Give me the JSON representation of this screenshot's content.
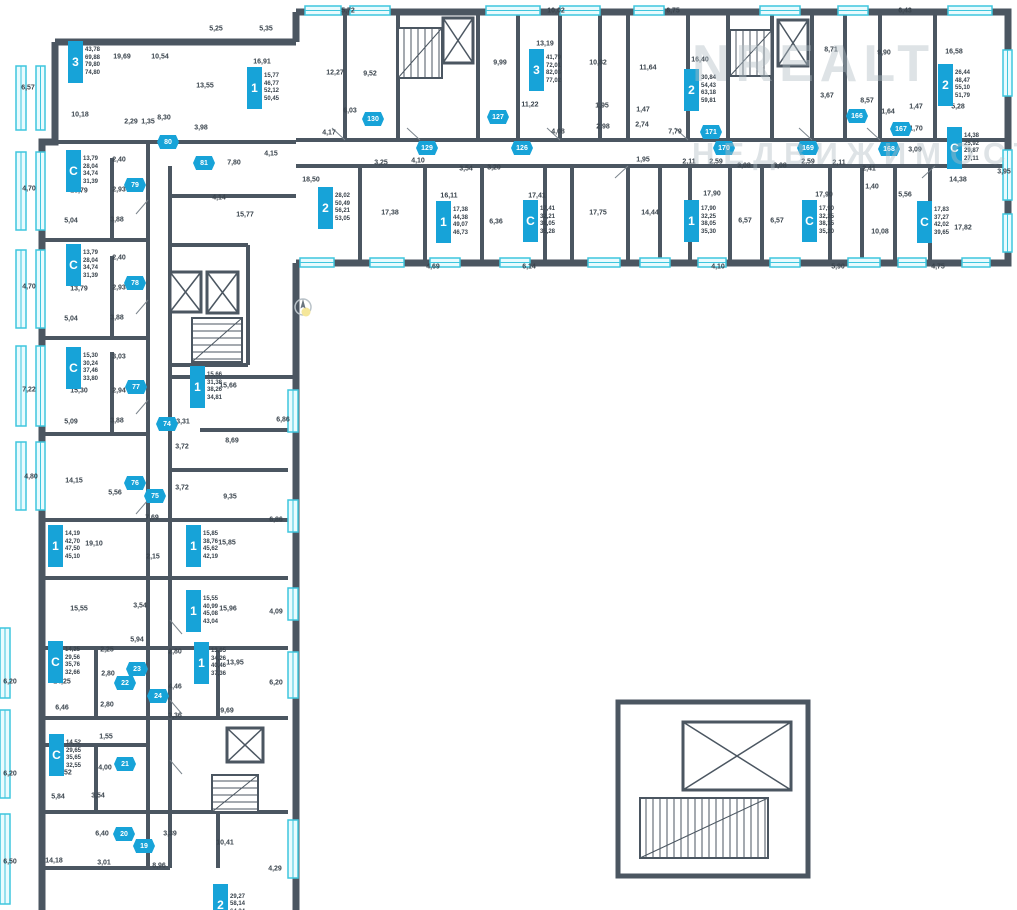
{
  "watermark": {
    "line1": "NREALT",
    "line2": "НЕДВИЖИМОСТЬ"
  },
  "colors": {
    "wall": "#4b5661",
    "accent": "#17a3d8",
    "window": "#3fc6de",
    "label": "#39434c"
  },
  "units": [
    {
      "type": "3",
      "x": 68,
      "y": 41,
      "areas": [
        "43,78",
        "69,88",
        "79,80",
        "74,80"
      ]
    },
    {
      "type": "1",
      "x": 247,
      "y": 67,
      "areas": [
        "15,77",
        "46,77",
        "52,12",
        "50,45"
      ]
    },
    {
      "type": "2",
      "x": 318,
      "y": 187,
      "areas": [
        "28,02",
        "50,49",
        "56,21",
        "53,05"
      ]
    },
    {
      "type": "1",
      "x": 436,
      "y": 201,
      "areas": [
        "17,38",
        "44,38",
        "49,07",
        "46,73"
      ]
    },
    {
      "type": "C",
      "x": 523,
      "y": 200,
      "areas": [
        "17,41",
        "32,21",
        "38,05",
        "35,28"
      ]
    },
    {
      "type": "3",
      "x": 529,
      "y": 49,
      "areas": [
        "41,79",
        "72,01",
        "82,03",
        "77,02"
      ]
    },
    {
      "type": "2",
      "x": 684,
      "y": 69,
      "areas": [
        "30,84",
        "54,43",
        "63,18",
        "59,81"
      ]
    },
    {
      "type": "1",
      "x": 684,
      "y": 200,
      "areas": [
        "17,90",
        "32,25",
        "38,05",
        "35,30"
      ]
    },
    {
      "type": "C",
      "x": 802,
      "y": 200,
      "areas": [
        "17,90",
        "32,25",
        "38,15",
        "35,20"
      ]
    },
    {
      "type": "2",
      "x": 938,
      "y": 64,
      "areas": [
        "26,44",
        "48,47",
        "55,10",
        "51,79"
      ]
    },
    {
      "type": "C",
      "x": 947,
      "y": 127,
      "areas": [
        "14,38",
        "25,92",
        "29,87",
        "27,11"
      ]
    },
    {
      "type": "C",
      "x": 917,
      "y": 201,
      "areas": [
        "17,83",
        "37,27",
        "42,02",
        "39,65"
      ]
    },
    {
      "type": "C",
      "x": 66,
      "y": 150,
      "areas": [
        "13,79",
        "28,04",
        "34,74",
        "31,39"
      ]
    },
    {
      "type": "C",
      "x": 66,
      "y": 244,
      "areas": [
        "13,79",
        "28,04",
        "34,74",
        "31,39"
      ]
    },
    {
      "type": "C",
      "x": 66,
      "y": 347,
      "areas": [
        "15,30",
        "30,24",
        "37,46",
        "33,80"
      ]
    },
    {
      "type": "1",
      "x": 190,
      "y": 366,
      "areas": [
        "15,66",
        "31,38",
        "38,26",
        "34,81"
      ]
    },
    {
      "type": "1",
      "x": 48,
      "y": 525,
      "areas": [
        "14,19",
        "42,70",
        "47,50",
        "45,10"
      ]
    },
    {
      "type": "1",
      "x": 186,
      "y": 525,
      "areas": [
        "15,85",
        "38,76",
        "45,62",
        "42,19"
      ]
    },
    {
      "type": "1",
      "x": 186,
      "y": 590,
      "areas": [
        "15,55",
        "40,99",
        "45,08",
        "43,04"
      ]
    },
    {
      "type": "C",
      "x": 48,
      "y": 641,
      "areas": [
        "14,25",
        "29,56",
        "35,76",
        "32,66"
      ]
    },
    {
      "type": "1",
      "x": 194,
      "y": 642,
      "areas": [
        "13,95",
        "34,26",
        "40,46",
        "37,36"
      ]
    },
    {
      "type": "C",
      "x": 49,
      "y": 734,
      "areas": [
        "14,52",
        "29,65",
        "35,65",
        "32,55"
      ]
    },
    {
      "type": "2",
      "x": 213,
      "y": 884,
      "areas": [
        "29,27",
        "58,14",
        "64,34"
      ]
    }
  ],
  "hex_badges": [
    {
      "x": 168,
      "y": 142,
      "label": "80"
    },
    {
      "x": 204,
      "y": 163,
      "label": "81"
    },
    {
      "x": 135,
      "y": 185,
      "label": "79"
    },
    {
      "x": 135,
      "y": 283,
      "label": "78"
    },
    {
      "x": 136,
      "y": 387,
      "label": "77"
    },
    {
      "x": 167,
      "y": 424,
      "label": "74"
    },
    {
      "x": 135,
      "y": 483,
      "label": "76"
    },
    {
      "x": 155,
      "y": 496,
      "label": "75"
    },
    {
      "x": 373,
      "y": 119,
      "label": "130"
    },
    {
      "x": 427,
      "y": 148,
      "label": "129"
    },
    {
      "x": 498,
      "y": 117,
      "label": "127"
    },
    {
      "x": 522,
      "y": 148,
      "label": "126"
    },
    {
      "x": 711,
      "y": 132,
      "label": "171"
    },
    {
      "x": 724,
      "y": 148,
      "label": "170"
    },
    {
      "x": 808,
      "y": 148,
      "label": "169"
    },
    {
      "x": 857,
      "y": 116,
      "label": "166"
    },
    {
      "x": 901,
      "y": 129,
      "label": "167"
    },
    {
      "x": 889,
      "y": 149,
      "label": "168"
    },
    {
      "x": 137,
      "y": 669,
      "label": "23"
    },
    {
      "x": 125,
      "y": 683,
      "label": "22"
    },
    {
      "x": 158,
      "y": 696,
      "label": "24"
    },
    {
      "x": 125,
      "y": 764,
      "label": "21"
    },
    {
      "x": 124,
      "y": 834,
      "label": "20"
    },
    {
      "x": 144,
      "y": 846,
      "label": "19"
    }
  ],
  "room_labels": [
    {
      "x": 122,
      "y": 57,
      "t": "19,69"
    },
    {
      "x": 160,
      "y": 57,
      "t": "10,54"
    },
    {
      "x": 205,
      "y": 86,
      "t": "13,55"
    },
    {
      "x": 80,
      "y": 115,
      "t": "10,18"
    },
    {
      "x": 131,
      "y": 122,
      "t": "2,29"
    },
    {
      "x": 148,
      "y": 122,
      "t": "1,35"
    },
    {
      "x": 164,
      "y": 118,
      "t": "8,30"
    },
    {
      "x": 201,
      "y": 128,
      "t": "3,98"
    },
    {
      "x": 28,
      "y": 88,
      "t": "6,57"
    },
    {
      "x": 216,
      "y": 29,
      "t": "5,25"
    },
    {
      "x": 266,
      "y": 29,
      "t": "5,35"
    },
    {
      "x": 262,
      "y": 62,
      "t": "16,91"
    },
    {
      "x": 271,
      "y": 154,
      "t": "4,15"
    },
    {
      "x": 234,
      "y": 163,
      "t": "7,80"
    },
    {
      "x": 219,
      "y": 198,
      "t": "4,14"
    },
    {
      "x": 245,
      "y": 215,
      "t": "15,77"
    },
    {
      "x": 335,
      "y": 73,
      "t": "12,27"
    },
    {
      "x": 370,
      "y": 74,
      "t": "9,52"
    },
    {
      "x": 350,
      "y": 111,
      "t": "6,03"
    },
    {
      "x": 329,
      "y": 133,
      "t": "4,17"
    },
    {
      "x": 311,
      "y": 180,
      "t": "18,50"
    },
    {
      "x": 381,
      "y": 163,
      "t": "3,25"
    },
    {
      "x": 418,
      "y": 161,
      "t": "4,10"
    },
    {
      "x": 390,
      "y": 213,
      "t": "17,38"
    },
    {
      "x": 449,
      "y": 196,
      "t": "16,11"
    },
    {
      "x": 466,
      "y": 169,
      "t": "3,54"
    },
    {
      "x": 494,
      "y": 168,
      "t": "3,20"
    },
    {
      "x": 537,
      "y": 196,
      "t": "17,41"
    },
    {
      "x": 496,
      "y": 222,
      "t": "6,36"
    },
    {
      "x": 500,
      "y": 63,
      "t": "9,99"
    },
    {
      "x": 545,
      "y": 44,
      "t": "13,19"
    },
    {
      "x": 598,
      "y": 63,
      "t": "10,82"
    },
    {
      "x": 648,
      "y": 68,
      "t": "11,64"
    },
    {
      "x": 530,
      "y": 105,
      "t": "11,22"
    },
    {
      "x": 602,
      "y": 106,
      "t": "1,95"
    },
    {
      "x": 643,
      "y": 110,
      "t": "1,47"
    },
    {
      "x": 558,
      "y": 132,
      "t": "4,08"
    },
    {
      "x": 603,
      "y": 127,
      "t": "2,98"
    },
    {
      "x": 642,
      "y": 125,
      "t": "2,74"
    },
    {
      "x": 643,
      "y": 160,
      "t": "1,95"
    },
    {
      "x": 598,
      "y": 213,
      "t": "17,75"
    },
    {
      "x": 650,
      "y": 213,
      "t": "14,44"
    },
    {
      "x": 700,
      "y": 60,
      "t": "16,40"
    },
    {
      "x": 675,
      "y": 132,
      "t": "7,79"
    },
    {
      "x": 831,
      "y": 50,
      "t": "8,71"
    },
    {
      "x": 884,
      "y": 53,
      "t": "9,90"
    },
    {
      "x": 954,
      "y": 52,
      "t": "16,58"
    },
    {
      "x": 827,
      "y": 96,
      "t": "3,67"
    },
    {
      "x": 867,
      "y": 101,
      "t": "8,57"
    },
    {
      "x": 888,
      "y": 112,
      "t": "1,64"
    },
    {
      "x": 916,
      "y": 107,
      "t": "1,47"
    },
    {
      "x": 958,
      "y": 107,
      "t": "5,28"
    },
    {
      "x": 916,
      "y": 129,
      "t": "1,70"
    },
    {
      "x": 915,
      "y": 150,
      "t": "3,09"
    },
    {
      "x": 869,
      "y": 169,
      "t": "2,41"
    },
    {
      "x": 872,
      "y": 187,
      "t": "1,40"
    },
    {
      "x": 905,
      "y": 195,
      "t": "5,56"
    },
    {
      "x": 958,
      "y": 180,
      "t": "14,38"
    },
    {
      "x": 1004,
      "y": 172,
      "t": "3,95"
    },
    {
      "x": 880,
      "y": 232,
      "t": "10,08"
    },
    {
      "x": 963,
      "y": 228,
      "t": "17,82"
    },
    {
      "x": 689,
      "y": 162,
      "t": "2,11"
    },
    {
      "x": 716,
      "y": 162,
      "t": "2,59"
    },
    {
      "x": 744,
      "y": 166,
      "t": "3,08"
    },
    {
      "x": 780,
      "y": 166,
      "t": "3,08"
    },
    {
      "x": 808,
      "y": 162,
      "t": "2,59"
    },
    {
      "x": 839,
      "y": 163,
      "t": "2,11"
    },
    {
      "x": 712,
      "y": 194,
      "t": "17,90"
    },
    {
      "x": 824,
      "y": 195,
      "t": "17,90"
    },
    {
      "x": 745,
      "y": 221,
      "t": "6,57"
    },
    {
      "x": 777,
      "y": 221,
      "t": "6,57"
    },
    {
      "x": 433,
      "y": 267,
      "t": "4,69"
    },
    {
      "x": 529,
      "y": 267,
      "t": "6,14"
    },
    {
      "x": 718,
      "y": 267,
      "t": "4,10"
    },
    {
      "x": 838,
      "y": 267,
      "t": "5,90"
    },
    {
      "x": 938,
      "y": 267,
      "t": "4,75"
    },
    {
      "x": 348,
      "y": 11,
      "t": "5,72"
    },
    {
      "x": 556,
      "y": 11,
      "t": "10,02"
    },
    {
      "x": 673,
      "y": 11,
      "t": "6,75"
    },
    {
      "x": 905,
      "y": 11,
      "t": "6,43"
    },
    {
      "x": 29,
      "y": 189,
      "t": "4,70"
    },
    {
      "x": 119,
      "y": 160,
      "t": "2,40"
    },
    {
      "x": 79,
      "y": 191,
      "t": "13,79"
    },
    {
      "x": 119,
      "y": 190,
      "t": "2,93"
    },
    {
      "x": 71,
      "y": 221,
      "t": "5,04"
    },
    {
      "x": 117,
      "y": 220,
      "t": "3,88"
    },
    {
      "x": 29,
      "y": 287,
      "t": "4,70"
    },
    {
      "x": 119,
      "y": 258,
      "t": "2,40"
    },
    {
      "x": 79,
      "y": 289,
      "t": "13,79"
    },
    {
      "x": 119,
      "y": 288,
      "t": "2,93"
    },
    {
      "x": 71,
      "y": 319,
      "t": "5,04"
    },
    {
      "x": 117,
      "y": 318,
      "t": "3,88"
    },
    {
      "x": 29,
      "y": 390,
      "t": "7,22"
    },
    {
      "x": 119,
      "y": 357,
      "t": "3,03"
    },
    {
      "x": 79,
      "y": 391,
      "t": "15,30"
    },
    {
      "x": 119,
      "y": 391,
      "t": "2,94"
    },
    {
      "x": 71,
      "y": 422,
      "t": "5,09"
    },
    {
      "x": 117,
      "y": 421,
      "t": "3,88"
    },
    {
      "x": 31,
      "y": 477,
      "t": "4,80"
    },
    {
      "x": 74,
      "y": 481,
      "t": "14,15"
    },
    {
      "x": 115,
      "y": 493,
      "t": "5,56"
    },
    {
      "x": 228,
      "y": 386,
      "t": "15,66"
    },
    {
      "x": 283,
      "y": 420,
      "t": "6,86"
    },
    {
      "x": 183,
      "y": 422,
      "t": "3,31"
    },
    {
      "x": 182,
      "y": 447,
      "t": "3,72"
    },
    {
      "x": 232,
      "y": 441,
      "t": "8,69"
    },
    {
      "x": 182,
      "y": 488,
      "t": "3,72"
    },
    {
      "x": 230,
      "y": 497,
      "t": "9,35"
    },
    {
      "x": 152,
      "y": 518,
      "t": "7,69"
    },
    {
      "x": 94,
      "y": 544,
      "t": "19,10"
    },
    {
      "x": 153,
      "y": 557,
      "t": "2,15"
    },
    {
      "x": 227,
      "y": 543,
      "t": "15,85"
    },
    {
      "x": 276,
      "y": 520,
      "t": "6,86"
    },
    {
      "x": 79,
      "y": 609,
      "t": "15,55"
    },
    {
      "x": 140,
      "y": 606,
      "t": "3,54"
    },
    {
      "x": 137,
      "y": 640,
      "t": "5,94"
    },
    {
      "x": 228,
      "y": 609,
      "t": "15,96"
    },
    {
      "x": 276,
      "y": 612,
      "t": "4,09"
    },
    {
      "x": 62,
      "y": 682,
      "t": "14,25"
    },
    {
      "x": 107,
      "y": 650,
      "t": "2,25"
    },
    {
      "x": 108,
      "y": 674,
      "t": "2,80"
    },
    {
      "x": 175,
      "y": 652,
      "t": "2,80"
    },
    {
      "x": 235,
      "y": 663,
      "t": "13,95"
    },
    {
      "x": 175,
      "y": 687,
      "t": "4,46"
    },
    {
      "x": 62,
      "y": 708,
      "t": "6,46"
    },
    {
      "x": 107,
      "y": 705,
      "t": "2,80"
    },
    {
      "x": 227,
      "y": 711,
      "t": "9,69"
    },
    {
      "x": 175,
      "y": 716,
      "t": "3,36"
    },
    {
      "x": 10,
      "y": 682,
      "t": "6,20"
    },
    {
      "x": 276,
      "y": 683,
      "t": "6,20"
    },
    {
      "x": 106,
      "y": 737,
      "t": "1,55"
    },
    {
      "x": 63,
      "y": 773,
      "t": "14,52"
    },
    {
      "x": 105,
      "y": 768,
      "t": "4,00"
    },
    {
      "x": 58,
      "y": 797,
      "t": "5,84"
    },
    {
      "x": 98,
      "y": 796,
      "t": "3,54"
    },
    {
      "x": 10,
      "y": 774,
      "t": "6,20"
    },
    {
      "x": 10,
      "y": 862,
      "t": "6,50"
    },
    {
      "x": 54,
      "y": 861,
      "t": "14,18"
    },
    {
      "x": 104,
      "y": 863,
      "t": "3,01"
    },
    {
      "x": 102,
      "y": 834,
      "t": "6,40"
    },
    {
      "x": 170,
      "y": 834,
      "t": "3,39"
    },
    {
      "x": 225,
      "y": 843,
      "t": "10,41"
    },
    {
      "x": 159,
      "y": 866,
      "t": "8,96"
    },
    {
      "x": 275,
      "y": 869,
      "t": "4,29"
    }
  ]
}
